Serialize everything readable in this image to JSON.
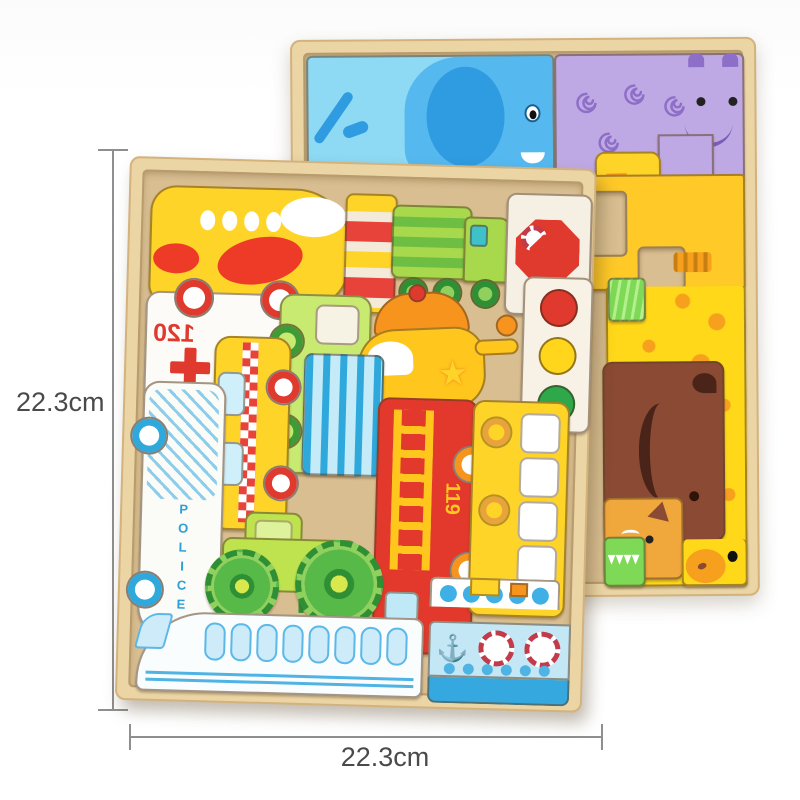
{
  "scene": {
    "description": "Product photo of two wooden chunky puzzle boards (vehicles front, animals behind) with size annotations"
  },
  "annotations": {
    "height_label": "22.3cm",
    "width_label": "22.3cm"
  },
  "front_board": {
    "name": "vehicles-puzzle-board",
    "texts": {
      "stop_sign": "STOP",
      "ambulance_number": "120",
      "police_car": "POLICE",
      "fire_truck_number": "119"
    },
    "pieces": [
      "airplane",
      "striped-barrier",
      "recycling-truck",
      "stop-sign",
      "ambulance",
      "green-van",
      "helicopter",
      "traffic-light",
      "blue-striped-block",
      "taxi",
      "police-car",
      "fire-truck",
      "school-bus",
      "tractor",
      "bullet-train",
      "ship"
    ]
  },
  "back_board": {
    "name": "animals-puzzle-board",
    "pieces": [
      "elephant",
      "hippo",
      "duck",
      "giraffe",
      "grass",
      "bear",
      "fox",
      "crocodile"
    ]
  },
  "icons": {
    "anchor": "⚓",
    "star": "★"
  },
  "colors": {
    "wood": "#EBD5A5",
    "wood_recess": "#D8BE90",
    "accent_red": "#E0392E",
    "accent_yellow": "#FFD428",
    "accent_green": "#6FBE44",
    "accent_blue": "#35A8E0",
    "hippo_purple": "#BFA9E4",
    "giraffe_yellow": "#FFD819",
    "bear_brown": "#8A4A33",
    "dimension_line": "#8F8F8F",
    "label_text": "#4a4a4a"
  }
}
